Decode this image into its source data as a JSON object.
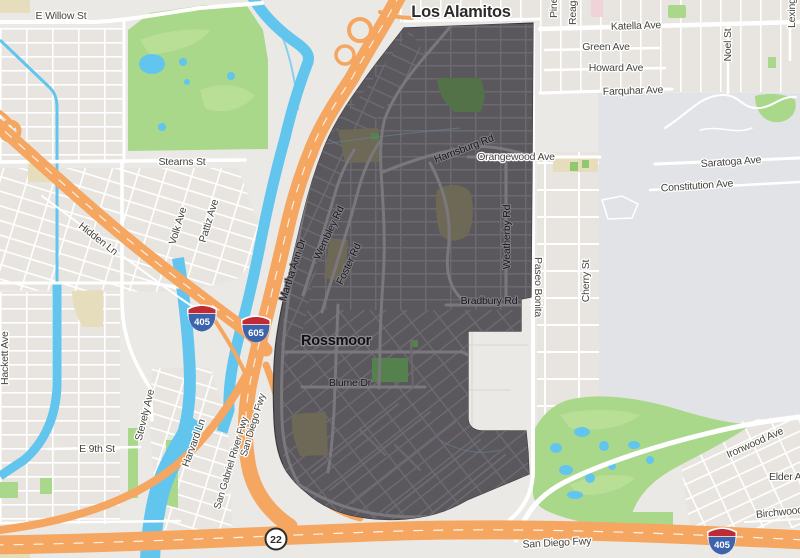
{
  "map": {
    "highlighted_region": "Rossmoor",
    "city_labels": {
      "los_alamitos": "Los Alamitos",
      "rossmoor": "Rossmoor"
    },
    "labels": {
      "e_willow": "E Willow St",
      "stearns": "Stearns St",
      "hidden_ln": "Hidden Ln",
      "volk": "Volk Ave",
      "pattiz": "Pattiz Ave",
      "hackett": "Hackett Ave",
      "stevely": "Stevely Ave",
      "e_9th": "E 9th St",
      "harvard": "Harvard Ln",
      "san_gabriel_river_fwy": "San Gabriel River Fwy",
      "san_diego_fwy_diag": "San Diego Fwy",
      "san_diego_fwy_bottom": "San Diego Fwy",
      "martha_ann": "Martha Ann Dr",
      "wembley": "Wembley Rd",
      "foster": "Foster Rd",
      "harrisburg": "Harrisburg Rd",
      "orangewood": "Orangewood Ave",
      "weatherby": "Weatherby Rd",
      "bradbury": "Bradbury Rd",
      "blume": "Blume Dr",
      "katella": "Katella Ave",
      "green": "Green Ave",
      "howard": "Howard Ave",
      "farquhar": "Farquhar Ave",
      "noel": "Noel St",
      "lexington": "Lexington",
      "pine": "Pine St",
      "reagan": "Reagan St",
      "saratoga": "Saratoga Ave",
      "constitution": "Constitution Ave",
      "paseo_bonita": "Paseo Bonita",
      "cherry": "Cherry St",
      "ironwood": "Ironwood Ave",
      "elder": "Elder Ave",
      "birchwood": "Birchwood Ave"
    },
    "shields": {
      "i405": "405",
      "i605": "605",
      "sr22": "22"
    },
    "colors": {
      "base_land": "#ebe9e5",
      "block_fill": "#e8e5e0",
      "region_fill": "#5a585c",
      "region_street": "#6c6a70",
      "region_main_road": "#7a787d",
      "freeway_orange": "#f5a661",
      "water_blue": "#62c5ee",
      "park_green": "#a9d88b",
      "region_park_green": "#55814d",
      "region_school_olive": "#6e6957",
      "military_area": "#e2e3e7",
      "shield_blue": "#3c63ac",
      "shield_red": "#bf2b33"
    }
  }
}
